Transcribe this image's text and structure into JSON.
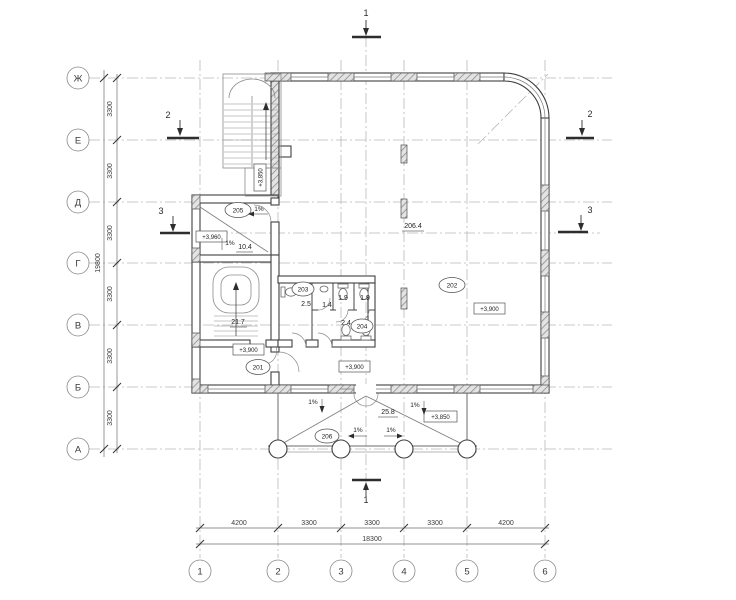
{
  "grid": {
    "rows": [
      {
        "label": "Ж"
      },
      {
        "label": "Е"
      },
      {
        "label": "Д"
      },
      {
        "label": "Г"
      },
      {
        "label": "В"
      },
      {
        "label": "Б"
      },
      {
        "label": "А"
      }
    ],
    "cols": [
      {
        "label": "1"
      },
      {
        "label": "2"
      },
      {
        "label": "3"
      },
      {
        "label": "4"
      },
      {
        "label": "5"
      },
      {
        "label": "6"
      }
    ]
  },
  "dims": {
    "left_segments": [
      "3300",
      "3300",
      "3300",
      "3300",
      "3300",
      "3300"
    ],
    "left_total": "19800",
    "bottom_segments": [
      "4200",
      "3300",
      "3300",
      "3300",
      "4200"
    ],
    "bottom_total": "18300"
  },
  "sections": {
    "top": "1",
    "bottom": "1",
    "left_upper": "2",
    "right_upper": "2",
    "left_lower": "3",
    "right_lower": "3"
  },
  "rooms": {
    "r201": {
      "tag": "201",
      "area": "21.7",
      "level": "+3,900"
    },
    "r202": {
      "tag": "202",
      "area": "206.4",
      "level": "+3,900"
    },
    "r203": {
      "tag": "203",
      "area": "2.5"
    },
    "r204": {
      "tag": "204"
    },
    "r205": {
      "tag": "205",
      "area": "10.4",
      "level": "+3,960",
      "slope_top": "1%",
      "slope_in": "1%"
    },
    "r206": {
      "tag": "206",
      "area": "25.8",
      "level": "+3,850",
      "slope_nw": "1%",
      "slope_ne": "1%",
      "slope_w": "1%",
      "slope_e": "1%"
    },
    "wc": {
      "lobby_area": "1.4",
      "stall1_area": "1.9",
      "stall2_area": "1.9",
      "corridor_area": "2.4"
    },
    "hall_south_level": "+3,900",
    "stair_landing_level": "+3,850"
  }
}
